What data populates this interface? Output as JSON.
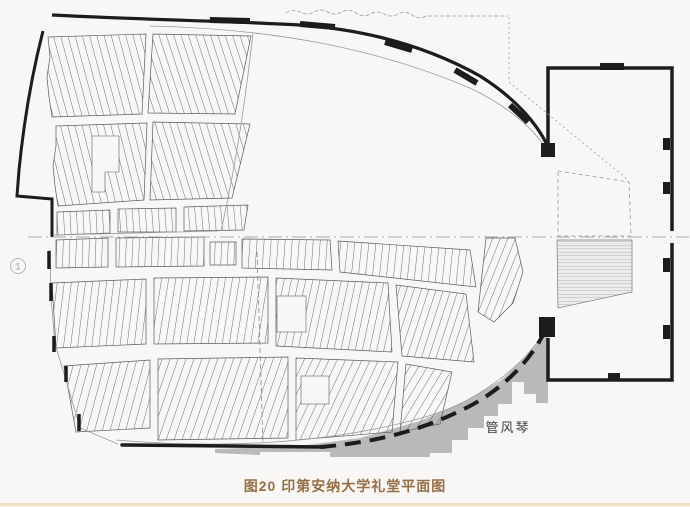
{
  "figure": {
    "caption": "图20 印第安纳大学礼堂平面图"
  },
  "plan": {
    "organ_label": "管风琴",
    "section_marker": "1"
  },
  "colors": {
    "ink": "#1c1c1c",
    "seat_line": "#4a4a4a",
    "shading_gray": "#b9b9b9",
    "caption_brown": "#956f45",
    "page_background": "#f8f7f5",
    "bottom_border": "#eedcc3"
  }
}
